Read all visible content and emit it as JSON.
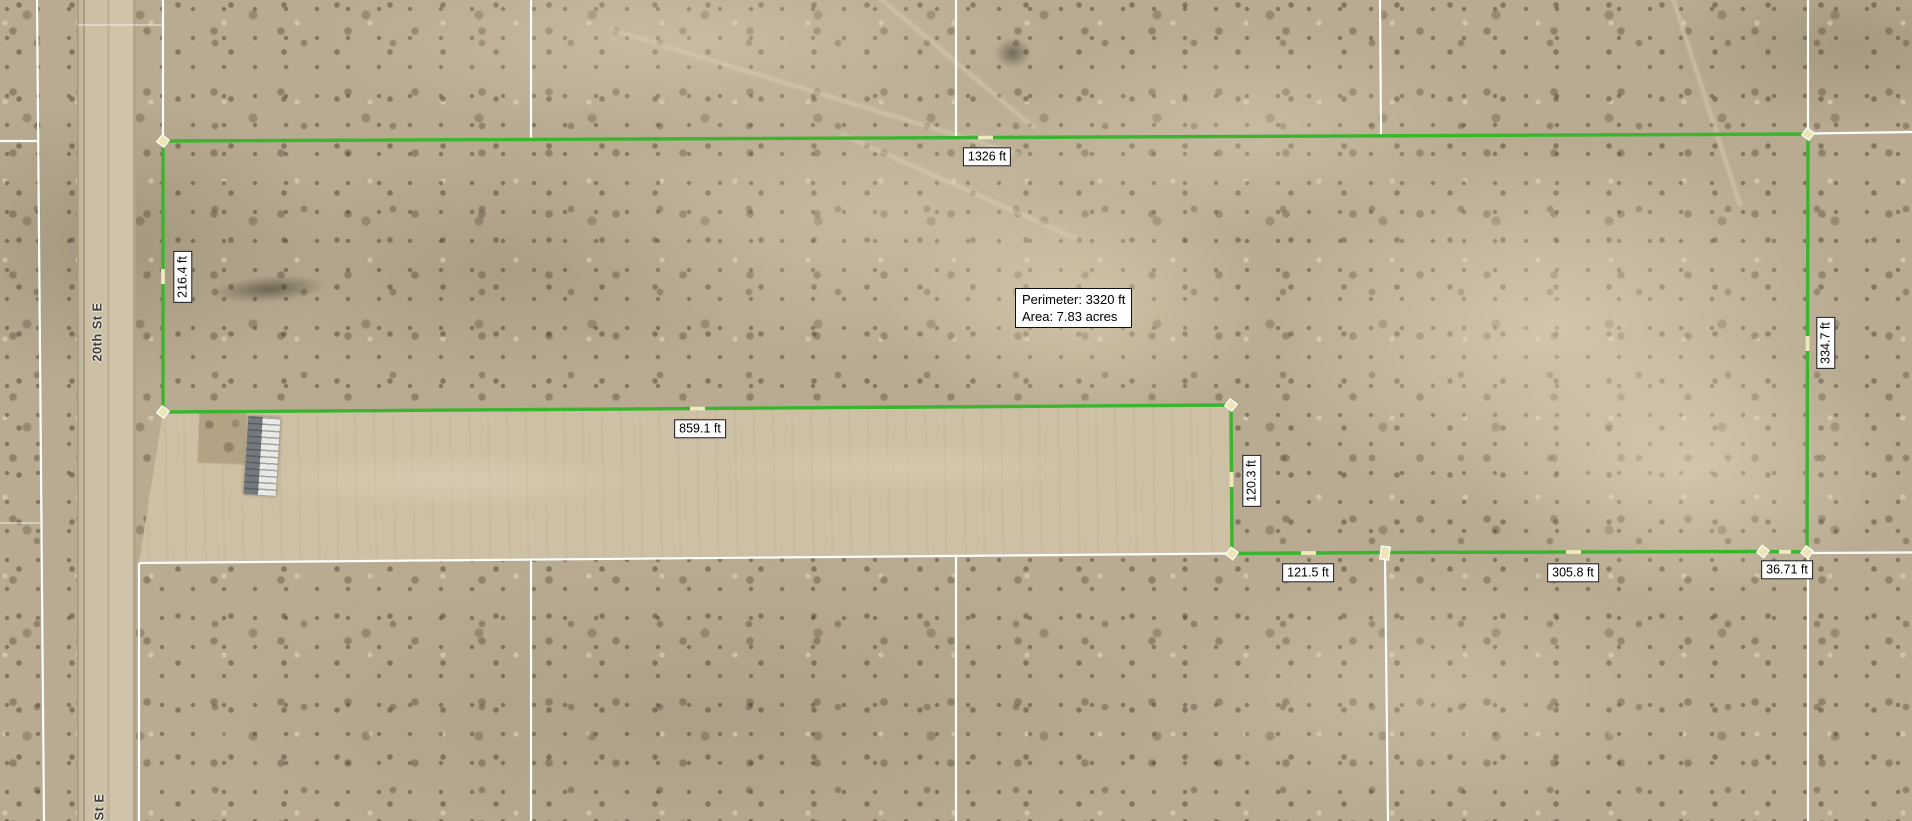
{
  "map": {
    "road": {
      "label": "20th St E",
      "label_partial": "St E"
    },
    "measurement_tool": {
      "segments": [
        {
          "name": "north-edge",
          "label": "1326 ft"
        },
        {
          "name": "west-edge",
          "label": "216.4 ft"
        },
        {
          "name": "east-edge",
          "label": "334.7 ft"
        },
        {
          "name": "inner-north-edge",
          "label": "859.1 ft"
        },
        {
          "name": "inner-east-edge",
          "label": "120.3 ft"
        },
        {
          "name": "south-edge-west",
          "label": "121.5 ft"
        },
        {
          "name": "south-edge-middle",
          "label": "305.8 ft"
        },
        {
          "name": "south-edge-east",
          "label": "36.71 ft"
        }
      ],
      "summary": {
        "perimeter": "Perimeter: 3320 ft",
        "area": "Area: 7.83 acres"
      },
      "colors": {
        "line": "#3bb42e",
        "vertex_fill": "#ece5b6",
        "vertex_stroke": "#ffffff",
        "midpoint_marker": "#efe9c0",
        "parcel_line": "#ffffff",
        "label_bg": "#fefefe",
        "label_border": "#111111",
        "label_text": "#000000"
      }
    }
  }
}
